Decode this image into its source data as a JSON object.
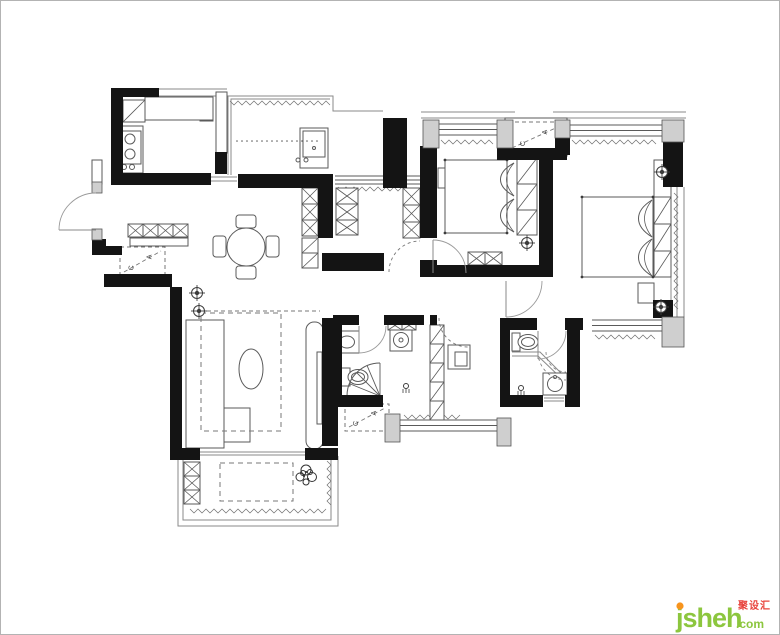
{
  "meta": {
    "canvas": {
      "w": 780,
      "h": 635
    },
    "colors": {
      "bg": "#ffffff",
      "frame": "#b3b3b3",
      "wall": "#141414",
      "line": "#5a5a5a",
      "soft": "#8a8a8a",
      "hatchline": "#6f6f6f",
      "pillar_fill": "#cfcfcf",
      "pillar_stroke": "#555555",
      "dash": "#777777",
      "symbol": "#3c3c3c"
    },
    "ac_label": {
      "letter_a": "A",
      "letter_c": "C"
    },
    "watermark": {
      "brand": "jsheh",
      "tld": ".com",
      "cn": "聚设汇",
      "green": "#8cc63e",
      "orange": "#f7941d",
      "red": "#e8433c"
    }
  },
  "plan": {
    "walls": [
      [
        111,
        88,
        48,
        9
      ],
      [
        111,
        88,
        12,
        86
      ],
      [
        111,
        173,
        100,
        12
      ],
      [
        215,
        152,
        12,
        22
      ],
      [
        238,
        174,
        95,
        14
      ],
      [
        318,
        188,
        15,
        50
      ],
      [
        383,
        118,
        24,
        70
      ],
      [
        420,
        146,
        17,
        92
      ],
      [
        420,
        260,
        17,
        17
      ],
      [
        322,
        253,
        62,
        18
      ],
      [
        92,
        239,
        14,
        15
      ],
      [
        92,
        246,
        30,
        9
      ],
      [
        104,
        274,
        68,
        13
      ],
      [
        170,
        287,
        12,
        168
      ],
      [
        170,
        448,
        30,
        12
      ],
      [
        305,
        448,
        33,
        12
      ],
      [
        322,
        318,
        20,
        84
      ],
      [
        322,
        400,
        16,
        46
      ],
      [
        333,
        315,
        26,
        10
      ],
      [
        384,
        315,
        40,
        10
      ],
      [
        333,
        395,
        50,
        12
      ],
      [
        500,
        318,
        37,
        12
      ],
      [
        565,
        318,
        18,
        12
      ],
      [
        500,
        318,
        10,
        89
      ],
      [
        500,
        395,
        43,
        12
      ],
      [
        565,
        395,
        15,
        12
      ],
      [
        567,
        328,
        13,
        79
      ],
      [
        539,
        155,
        14,
        122
      ],
      [
        555,
        138,
        15,
        17
      ],
      [
        497,
        148,
        70,
        12
      ],
      [
        437,
        265,
        103,
        12
      ],
      [
        663,
        140,
        20,
        47
      ],
      [
        653,
        300,
        20,
        18
      ],
      [
        430,
        315,
        7,
        10
      ]
    ],
    "pillars": [
      [
        92,
        182,
        10,
        11
      ],
      [
        92,
        229,
        10,
        11
      ],
      [
        423,
        120,
        16,
        28
      ],
      [
        497,
        120,
        16,
        28
      ],
      [
        555,
        120,
        15,
        18
      ],
      [
        662,
        120,
        22,
        22
      ],
      [
        662,
        317,
        22,
        30
      ],
      [
        385,
        414,
        15,
        28
      ],
      [
        497,
        418,
        14,
        28
      ]
    ],
    "thin_rects": [
      {
        "n": "kitchen-glass-door",
        "r": [
          216,
          92,
          11,
          61
        ]
      },
      {
        "n": "entry-upper-wall",
        "r": [
          92,
          160,
          10,
          24
        ]
      },
      {
        "n": "kitchen-counter-top",
        "r": [
          145,
          97,
          68,
          23
        ]
      },
      {
        "n": "kitchen-counter-left",
        "r": [
          119,
          126,
          24,
          47
        ]
      },
      {
        "n": "stove",
        "r": [
          121,
          131,
          20,
          33
        ]
      },
      {
        "n": "ac-platform",
        "r": [
          505,
          118,
          62,
          38
        ]
      },
      {
        "n": "entry-console",
        "r": [
          130,
          238,
          58,
          8
        ]
      },
      {
        "n": "tv-cabinet",
        "r": [
          306,
          322,
          17,
          127
        ],
        "rx": 8
      },
      {
        "n": "tv",
        "r": [
          317,
          352,
          5,
          72
        ]
      },
      {
        "n": "master-tv-bench",
        "r": [
          638,
          283,
          16,
          20
        ]
      },
      {
        "n": "master-light-box",
        "r": [
          654,
          160,
          17,
          37
        ]
      },
      {
        "n": "desk",
        "r": [
          448,
          345,
          22,
          24
        ]
      },
      {
        "n": "desk-chair",
        "r": [
          455,
          352,
          12,
          14
        ]
      },
      {
        "n": "sofa",
        "r": [
          186,
          320,
          38,
          128
        ]
      },
      {
        "n": "sofa-chaise",
        "r": [
          224,
          408,
          26,
          34
        ]
      },
      {
        "n": "bed-small",
        "r": [
          445,
          160,
          62,
          73
        ]
      },
      {
        "n": "bed-master",
        "r": [
          582,
          197,
          71,
          80
        ]
      },
      {
        "n": "bedside-shelf",
        "r": [
          438,
          168,
          7,
          20
        ]
      },
      {
        "n": "bath1-sink-counter",
        "r": [
          335,
          331,
          24,
          22
        ]
      },
      {
        "n": "bath2-sink-counter",
        "r": [
          543,
          373,
          24,
          22
        ]
      },
      {
        "n": "bath1-toilet-tank",
        "r": [
          341,
          368,
          9,
          18
        ]
      },
      {
        "n": "bath2-toilet-tank",
        "r": [
          512,
          333,
          8,
          18
        ]
      },
      {
        "n": "washing-machine",
        "r": [
          390,
          330,
          22,
          21
        ]
      },
      {
        "n": "pantry-sink-counter",
        "r": [
          300,
          128,
          28,
          40
        ]
      },
      {
        "n": "pantry-sink-basin",
        "r": [
          303,
          131,
          22,
          26
        ]
      },
      {
        "n": "dining-chair",
        "r": [
          236,
          215,
          20,
          13
        ],
        "rx": 3
      },
      {
        "n": "dining-chair",
        "r": [
          236,
          266,
          20,
          13
        ],
        "rx": 3
      },
      {
        "n": "dining-chair",
        "r": [
          213,
          236,
          13,
          21
        ],
        "rx": 3
      },
      {
        "n": "dining-chair",
        "r": [
          266,
          236,
          13,
          21
        ],
        "rx": 3
      }
    ],
    "plines": [
      [
        [
          228,
          175
        ],
        [
          228,
          96
        ],
        [
          333,
          96
        ],
        [
          333,
          111
        ],
        [
          383,
          111
        ]
      ],
      [
        [
          231,
          175
        ],
        [
          231,
          99
        ],
        [
          330,
          99
        ]
      ],
      [
        [
          159,
          89
        ],
        [
          227,
          89
        ]
      ],
      [
        [
          159,
          96
        ],
        [
          227,
          96
        ]
      ],
      [
        [
          421,
          112
        ],
        [
          515,
          112
        ]
      ],
      [
        [
          421,
          118
        ],
        [
          515,
          118
        ]
      ],
      [
        [
          553,
          112
        ],
        [
          686,
          112
        ]
      ],
      [
        [
          553,
          118
        ],
        [
          686,
          118
        ]
      ],
      [
        [
          671,
          187
        ],
        [
          671,
          317
        ]
      ],
      [
        [
          677,
          187
        ],
        [
          677,
          317
        ]
      ],
      [
        [
          684,
          187
        ],
        [
          684,
          317
        ]
      ],
      [
        [
          178,
          456
        ],
        [
          178,
          526
        ],
        [
          338,
          526
        ],
        [
          338,
          456
        ]
      ],
      [
        [
          183,
          456
        ],
        [
          183,
          520
        ],
        [
          331,
          520
        ],
        [
          331,
          456
        ]
      ],
      [
        [
          200,
          452
        ],
        [
          305,
          452
        ]
      ],
      [
        [
          200,
          455
        ],
        [
          305,
          455
        ]
      ],
      [
        [
          211,
          177
        ],
        [
          237,
          177
        ]
      ],
      [
        [
          211,
          181
        ],
        [
          237,
          181
        ]
      ],
      [
        [
          544,
          398
        ],
        [
          564,
          398
        ]
      ],
      [
        [
          544,
          401
        ],
        [
          564,
          401
        ]
      ],
      [
        [
          197,
          322
        ],
        [
          197,
          446
        ]
      ],
      [
        [
          186,
          362
        ],
        [
          224,
          362
        ]
      ],
      [
        [
          186,
          406
        ],
        [
          224,
          406
        ]
      ],
      [
        [
          221,
          94
        ],
        [
          221,
          151
        ]
      ],
      [
        [
          512,
          352
        ],
        [
          540,
          352
        ],
        [
          563,
          375
        ]
      ],
      [
        [
          512,
          356
        ],
        [
          538,
          356
        ],
        [
          561,
          378
        ]
      ],
      [
        [
          314,
          150
        ],
        [
          314,
          157
        ]
      ]
    ],
    "hwindows": [
      [
        335,
        176,
        85,
        8
      ],
      [
        439,
        124,
        58,
        11
      ],
      [
        570,
        125,
        92,
        11
      ],
      [
        592,
        320,
        70,
        11
      ],
      [
        400,
        420,
        98,
        11
      ]
    ],
    "scribbles_h": [
      [
        230,
        101,
        100
      ],
      [
        338,
        187,
        64
      ],
      [
        441,
        140,
        52
      ],
      [
        572,
        140,
        86
      ],
      [
        595,
        335,
        60
      ],
      [
        404,
        415,
        56
      ],
      [
        190,
        509,
        138
      ]
    ],
    "scribbles_v": [
      [
        327,
        461,
        46
      ],
      [
        674,
        193,
        118
      ]
    ],
    "hatch_boxes": [
      [
        148,
        99,
        20,
        19
      ],
      [
        168,
        99,
        20,
        19
      ],
      [
        200,
        108,
        13,
        13
      ],
      [
        128,
        224,
        15,
        13
      ],
      [
        143,
        224,
        15,
        13
      ],
      [
        158,
        224,
        15,
        13
      ],
      [
        173,
        224,
        15,
        13
      ],
      [
        302,
        188,
        16,
        16
      ],
      [
        302,
        204,
        16,
        16
      ],
      [
        302,
        220,
        16,
        16
      ],
      [
        336,
        188,
        22,
        16
      ],
      [
        336,
        204,
        22,
        16
      ],
      [
        336,
        220,
        22,
        15
      ],
      [
        403,
        188,
        17,
        17
      ],
      [
        403,
        205,
        17,
        17
      ],
      [
        403,
        222,
        17,
        16
      ],
      [
        468,
        252,
        17,
        13
      ],
      [
        485,
        252,
        17,
        13
      ],
      [
        388,
        321,
        14,
        9
      ],
      [
        402,
        321,
        14,
        9
      ],
      [
        184,
        462,
        16,
        14
      ],
      [
        184,
        476,
        16,
        14
      ],
      [
        184,
        490,
        16,
        14
      ]
    ],
    "diag_boxes": [
      [
        302,
        238,
        16,
        15
      ],
      [
        302,
        253,
        16,
        15
      ],
      [
        430,
        325,
        14,
        19
      ],
      [
        430,
        344,
        14,
        19
      ],
      [
        430,
        363,
        14,
        19
      ],
      [
        430,
        382,
        14,
        19
      ],
      [
        430,
        401,
        14,
        19
      ],
      [
        517,
        158,
        20,
        26
      ],
      [
        517,
        184,
        20,
        26
      ],
      [
        517,
        210,
        20,
        25
      ],
      [
        654,
        197,
        17,
        27
      ],
      [
        654,
        224,
        17,
        27
      ],
      [
        654,
        251,
        17,
        26
      ],
      [
        123,
        100,
        22,
        22
      ]
    ],
    "circles": [
      {
        "n": "stove-burner",
        "c": [
          130,
          139
        ],
        "r": 5
      },
      {
        "n": "stove-burner",
        "c": [
          130,
          154
        ],
        "r": 5
      },
      {
        "n": "stove-knob",
        "c": [
          124,
          167
        ],
        "r": 2.5
      },
      {
        "n": "stove-knob",
        "c": [
          132,
          167
        ],
        "r": 2.5
      },
      {
        "n": "dining-table",
        "c": [
          246,
          247
        ],
        "r": 19
      },
      {
        "n": "washer-drum",
        "c": [
          401,
          340
        ],
        "r": 7.5
      },
      {
        "n": "washer-center",
        "c": [
          401,
          340
        ],
        "r": 2
      },
      {
        "n": "bath2-basin",
        "c": [
          555,
          384
        ],
        "r": 7.5
      },
      {
        "n": "bath2-tap-dot",
        "c": [
          555,
          377
        ],
        "r": 1.5
      },
      {
        "n": "pantry-tap-dot",
        "c": [
          306,
          160
        ],
        "r": 2
      },
      {
        "n": "pantry-tap-dot",
        "c": [
          298,
          160
        ],
        "r": 2
      },
      {
        "n": "pantry-tap-dot",
        "c": [
          314,
          148
        ],
        "r": 1.5
      }
    ],
    "ellipses": [
      {
        "n": "coffee-table",
        "c": [
          251,
          369
        ],
        "rx": 12,
        "ry": 20
      },
      {
        "n": "bath1-basin",
        "c": [
          347,
          342
        ],
        "rx": 7.5,
        "ry": 6
      },
      {
        "n": "bath1-toilet-bowl",
        "c": [
          358,
          377
        ],
        "rx": 10,
        "ry": 7.5
      },
      {
        "n": "bath1-toilet-seat",
        "c": [
          358,
          377
        ],
        "rx": 6.5,
        "ry": 4.5
      },
      {
        "n": "bath2-toilet-bowl",
        "c": [
          528,
          342
        ],
        "rx": 10,
        "ry": 7.5
      },
      {
        "n": "bath2-toilet-seat",
        "c": [
          528,
          342
        ],
        "rx": 6.5,
        "ry": 4.5
      }
    ],
    "dashed_rects": [
      {
        "n": "living-rug",
        "r": [
          201,
          313,
          80,
          118
        ]
      },
      {
        "n": "balcony-mat",
        "r": [
          220,
          463,
          73,
          38
        ]
      }
    ],
    "ac_boxes": [
      [
        120,
        247,
        45,
        29
      ],
      [
        508,
        122,
        56,
        30
      ],
      [
        345,
        404,
        44,
        27
      ]
    ],
    "doors": [
      {
        "n": "entry-door",
        "leaf": [
          [
            96,
            230
          ],
          [
            59,
            230
          ]
        ],
        "arc": "M59,230 A37,37 0 0 1 96,193"
      },
      {
        "n": "bedroom-small-door",
        "leaf": [
          [
            433,
            273
          ],
          [
            433,
            240
          ]
        ],
        "arc": "M433,240 A33,33 0 0 1 466,273"
      },
      {
        "n": "bath1-door",
        "leaf": [
          [
            359,
            326
          ],
          [
            359,
            353
          ]
        ],
        "arc": "M359,353 A27,27 0 0 0 386,326"
      },
      {
        "n": "bath2-door",
        "leaf": [
          [
            538,
            331
          ],
          [
            538,
            359
          ]
        ],
        "arc": "M538,359 A28,28 0 0 0 566,331"
      },
      {
        "n": "master-door",
        "leaf": [
          [
            506,
            281
          ],
          [
            506,
            317
          ]
        ],
        "arc": "M506,317 A36,36 0 0 0 542,281"
      }
    ],
    "dashed_doors": [
      {
        "n": "closet-door",
        "arc": "M389,272 A31,31 0 0 1 420,241"
      },
      {
        "n": "study-door",
        "arc": "M439,318 A29,29 0 0 0 468,347"
      }
    ],
    "dashed_arcs": [
      {
        "n": "shower2-arc",
        "d": "M546,352 A20,20 0 0 0 566,372"
      },
      {
        "n": "shower2-arc",
        "d": "M538,352 A28,28 0 0 0 566,380"
      }
    ],
    "lights": [
      [
        197,
        293
      ],
      [
        199,
        311
      ],
      [
        527,
        243
      ],
      [
        662,
        172
      ],
      [
        661,
        307
      ]
    ],
    "shower_heads": [
      [
        406,
        386
      ],
      [
        521,
        388
      ]
    ],
    "fan_shower": {
      "apex": [
        380,
        396
      ],
      "r": 33,
      "angles": [
        180,
        202,
        225,
        247,
        270
      ]
    },
    "pillows": [
      [
        499,
        163,
        15,
        33
      ],
      [
        499,
        199,
        15,
        33
      ],
      [
        637,
        200,
        15,
        37
      ],
      [
        637,
        239,
        15,
        37
      ]
    ],
    "bed_dot_rects": [
      [
        445,
        160,
        62,
        73
      ],
      [
        582,
        197,
        71,
        80
      ]
    ],
    "dashed_lines": [
      [
        [
          207,
          311
        ],
        [
          320,
          311
        ]
      ]
    ],
    "dot_rows": [
      {
        "x1": 237,
        "x2": 318,
        "y": 141,
        "step": 5
      }
    ],
    "plant": {
      "c": [
        306,
        474
      ]
    }
  }
}
